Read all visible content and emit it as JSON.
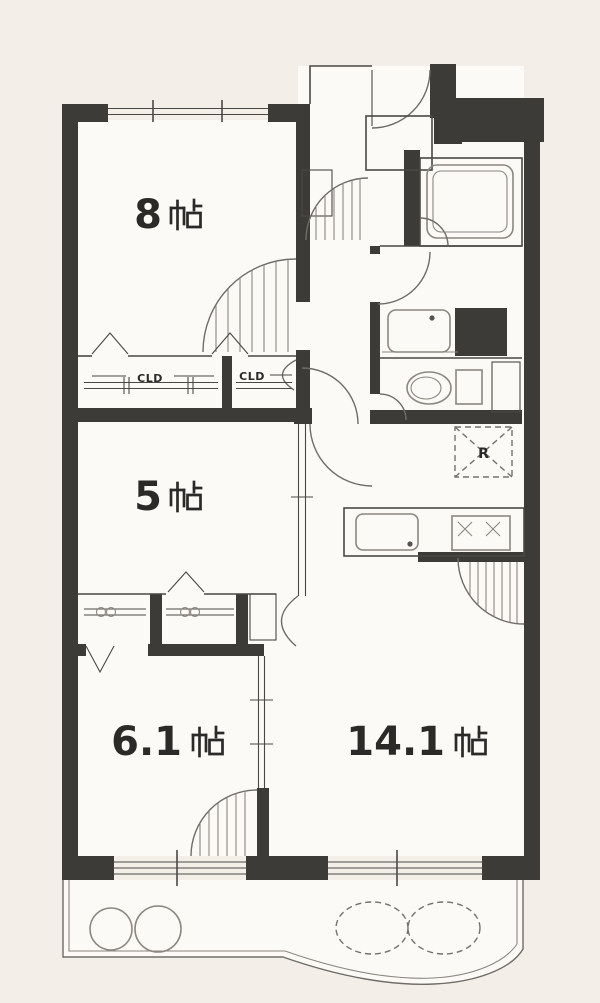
{
  "meta": {
    "type": "apartment-floor-plan"
  },
  "colors": {
    "background": "#f3efe8",
    "wall": "#3d3b38",
    "line": "#4a4845",
    "fixture": "#8b8781",
    "room": "#fbfaf6",
    "text": "#2b2a28"
  },
  "rooms": {
    "bedroom_top": {
      "label": "8帖",
      "number": "8",
      "unit": "帖"
    },
    "bedroom_middle": {
      "label": "5帖",
      "number": "5",
      "unit": "帖"
    },
    "bedroom_bottom": {
      "label": "6.1 帖",
      "number": "6.1",
      "unit": "帖"
    },
    "living_dining_kitchen": {
      "label": "14.1 帖",
      "number": "14.1",
      "unit": "帖"
    }
  },
  "closets": {
    "upper_left_label": "CLD",
    "upper_right_label": "CLD"
  },
  "kitchen": {
    "refrigerator_label": "R"
  }
}
